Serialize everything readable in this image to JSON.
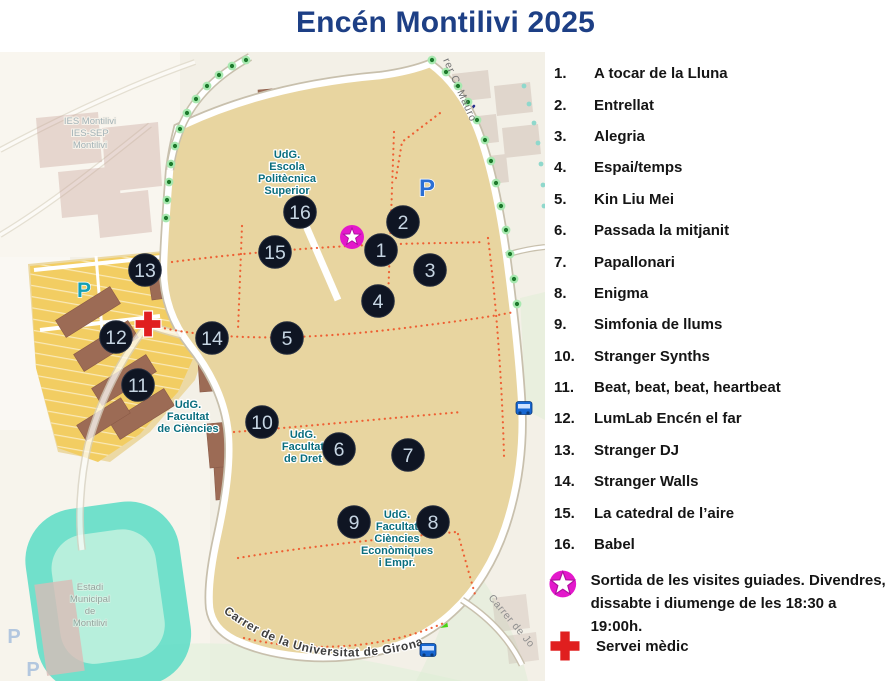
{
  "title": "Encén Montilivi 2025",
  "legend": {
    "items": [
      {
        "num": "1.",
        "label": "A tocar de la Lluna"
      },
      {
        "num": "2.",
        "label": "Entrellat"
      },
      {
        "num": "3.",
        "label": "Alegria"
      },
      {
        "num": "4.",
        "label": "Espai/temps"
      },
      {
        "num": "5.",
        "label": "Kin Liu Mei"
      },
      {
        "num": "6.",
        "label": "Passada la mitjanit"
      },
      {
        "num": "7.",
        "label": "Papallonari"
      },
      {
        "num": "8.",
        "label": "Enigma"
      },
      {
        "num": "9.",
        "label": "Simfonia de llums"
      },
      {
        "num": "10.",
        "label": "Stranger Synths"
      },
      {
        "num": "11.",
        "label": "Beat, beat, beat, heartbeat"
      },
      {
        "num": "12.",
        "label": "LumLab Encén el far"
      },
      {
        "num": "13.",
        "label": "Stranger DJ"
      },
      {
        "num": "14.",
        "label": "Stranger Walls"
      },
      {
        "num": "15.",
        "label": "La catedral de l’aire"
      },
      {
        "num": "16.",
        "label": "Babel"
      }
    ],
    "star_note_line1": "Sortida de les visites guiades. Divendres,",
    "star_note_line2": "dissabte i diumenge de les 18:30 a 19:00h.",
    "medic_label": "Servei mèdic"
  },
  "map": {
    "markers": [
      {
        "n": "1",
        "x": 381,
        "y": 250
      },
      {
        "n": "2",
        "x": 403,
        "y": 222
      },
      {
        "n": "3",
        "x": 430,
        "y": 270
      },
      {
        "n": "4",
        "x": 378,
        "y": 301
      },
      {
        "n": "5",
        "x": 287,
        "y": 338
      },
      {
        "n": "6",
        "x": 339,
        "y": 449
      },
      {
        "n": "7",
        "x": 408,
        "y": 455
      },
      {
        "n": "8",
        "x": 433,
        "y": 522
      },
      {
        "n": "9",
        "x": 354,
        "y": 522
      },
      {
        "n": "10",
        "x": 262,
        "y": 422
      },
      {
        "n": "11",
        "x": 138,
        "y": 385
      },
      {
        "n": "12",
        "x": 116,
        "y": 337
      },
      {
        "n": "13",
        "x": 145,
        "y": 270
      },
      {
        "n": "14",
        "x": 212,
        "y": 338
      },
      {
        "n": "15",
        "x": 275,
        "y": 252
      },
      {
        "n": "16",
        "x": 300,
        "y": 212
      }
    ],
    "campus_labels": [
      {
        "name": "udg-escola-politecnica",
        "x": 287,
        "y": 158,
        "cls": "lbl-udg",
        "lines": [
          "UdG.",
          "Escola",
          "Politècnica",
          "Superior"
        ]
      },
      {
        "name": "udg-facultat-ciencies",
        "x": 188,
        "y": 408,
        "cls": "lbl-udg",
        "lines": [
          "UdG.",
          "Facultat",
          "de Ciències"
        ]
      },
      {
        "name": "udg-facultat-dret",
        "x": 303,
        "y": 438,
        "cls": "lbl-udg",
        "lines": [
          "UdG.",
          "Facultat",
          "de Dret"
        ]
      },
      {
        "name": "udg-facultat-economiques",
        "x": 397,
        "y": 518,
        "cls": "lbl-udg",
        "lines": [
          "UdG.",
          "Facultat",
          "Ciències",
          "Econòmiques",
          "i Empr."
        ]
      },
      {
        "name": "ies-montilivi",
        "x": 90,
        "y": 124,
        "cls": "lbl-faded",
        "lines": [
          "IES Montilivi",
          "IES-SEP",
          "Montilivi"
        ]
      },
      {
        "name": "estadi-municipal",
        "x": 90,
        "y": 590,
        "cls": "lbl-stadium",
        "lines": [
          "Estadi",
          "Municipal",
          "de",
          "Montilivi"
        ]
      }
    ],
    "street_labels": {
      "bottom": "Carrer de la Universitat de Girona",
      "top_right": "rer C. Mauro",
      "bottom_right": "Carrer de Jo"
    },
    "parking_letters": [
      {
        "t": "P",
        "x": 427,
        "y": 196,
        "cls": "p-blue"
      },
      {
        "t": "P",
        "x": 84,
        "y": 297,
        "cls": "p-teal"
      },
      {
        "t": "P",
        "x": 14,
        "y": 643,
        "cls": "p-faded"
      },
      {
        "t": "P",
        "x": 33,
        "y": 676,
        "cls": "p-faded"
      }
    ]
  },
  "colors": {
    "title_blue": "#1d3f85",
    "marker": "#0f1523",
    "marker_text": "#c6d5e3",
    "star_magenta": "#e318cb",
    "cross_red": "#e01f1f",
    "udg_label_teal": "#0a6e7e",
    "campus_tan": "#e8d5a0",
    "parking_yellow": "#f2cd62",
    "building_brown": "#9c6b55",
    "green": "#5cc23c",
    "stadium_teal": "#59dcc6"
  }
}
